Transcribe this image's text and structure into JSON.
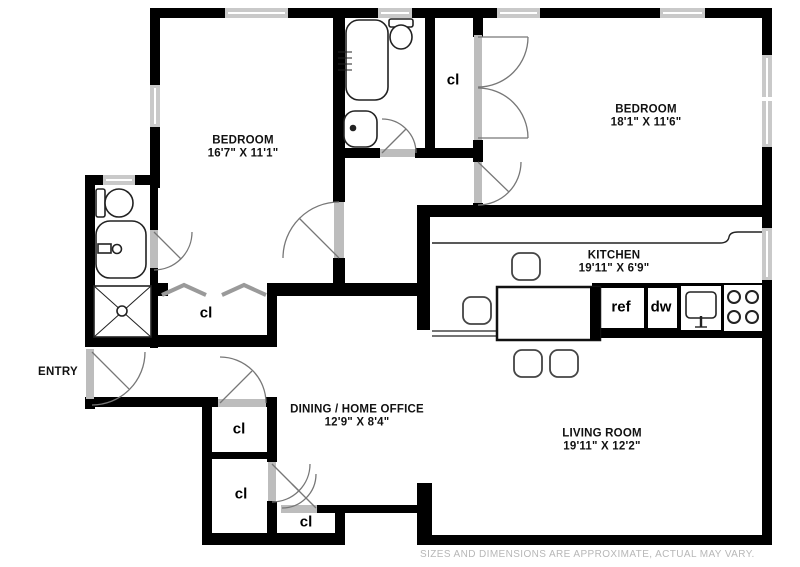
{
  "plan": {
    "rooms": {
      "bedroom1": {
        "name": "BEDROOM",
        "dims": "16'7\" X 11'1\""
      },
      "bedroom2": {
        "name": "BEDROOM",
        "dims": "18'1\" X 11'6\""
      },
      "kitchen": {
        "name": "KITCHEN",
        "dims": "19'11\" X 6'9\""
      },
      "living_room": {
        "name": "LIVING ROOM",
        "dims": "19'11\" X 12'2\""
      },
      "dining": {
        "name": "DINING / HOME OFFICE",
        "dims": "12'9\" X 8'4\""
      },
      "entry": {
        "name": "ENTRY"
      }
    },
    "closets": [
      {
        "label": "cl"
      },
      {
        "label": "cl"
      },
      {
        "label": "cl"
      },
      {
        "label": "cl"
      },
      {
        "label": "cl"
      }
    ],
    "appliances": {
      "refrigerator": "ref",
      "dishwasher": "dw"
    },
    "footer": {
      "disclaimer": "SIZES AND DIMENSIONS ARE APPROXIMATE, ACTUAL MAY VARY."
    },
    "colors": {
      "wall": "#000000",
      "window": "#c9c9c9",
      "door_swing": "#777777",
      "fixture": "#222222",
      "label": "#111111",
      "disclaimer": "#b7b7b7",
      "background": "#ffffff"
    }
  }
}
